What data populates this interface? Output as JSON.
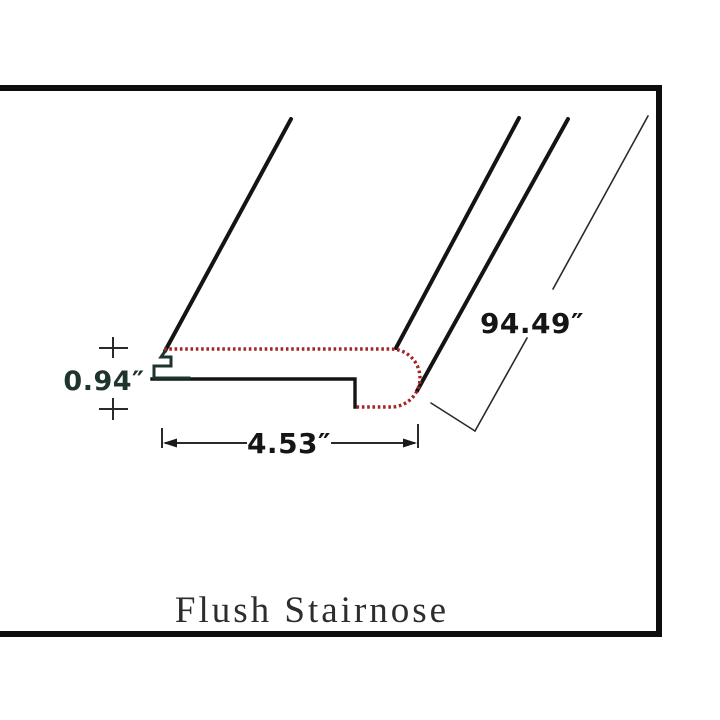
{
  "diagram": {
    "title": "Flush Stairnose",
    "dimensions": {
      "thickness": "0.94″",
      "width": "4.53″",
      "length": "94.49″"
    },
    "colors": {
      "outline": "#141414",
      "frame": "#0d0d0d",
      "surface_dotted_red": "#a82424",
      "thickness_accent_green": "#1e352c",
      "label_black": "#151515",
      "title_gray": "#2d2d2d"
    }
  }
}
